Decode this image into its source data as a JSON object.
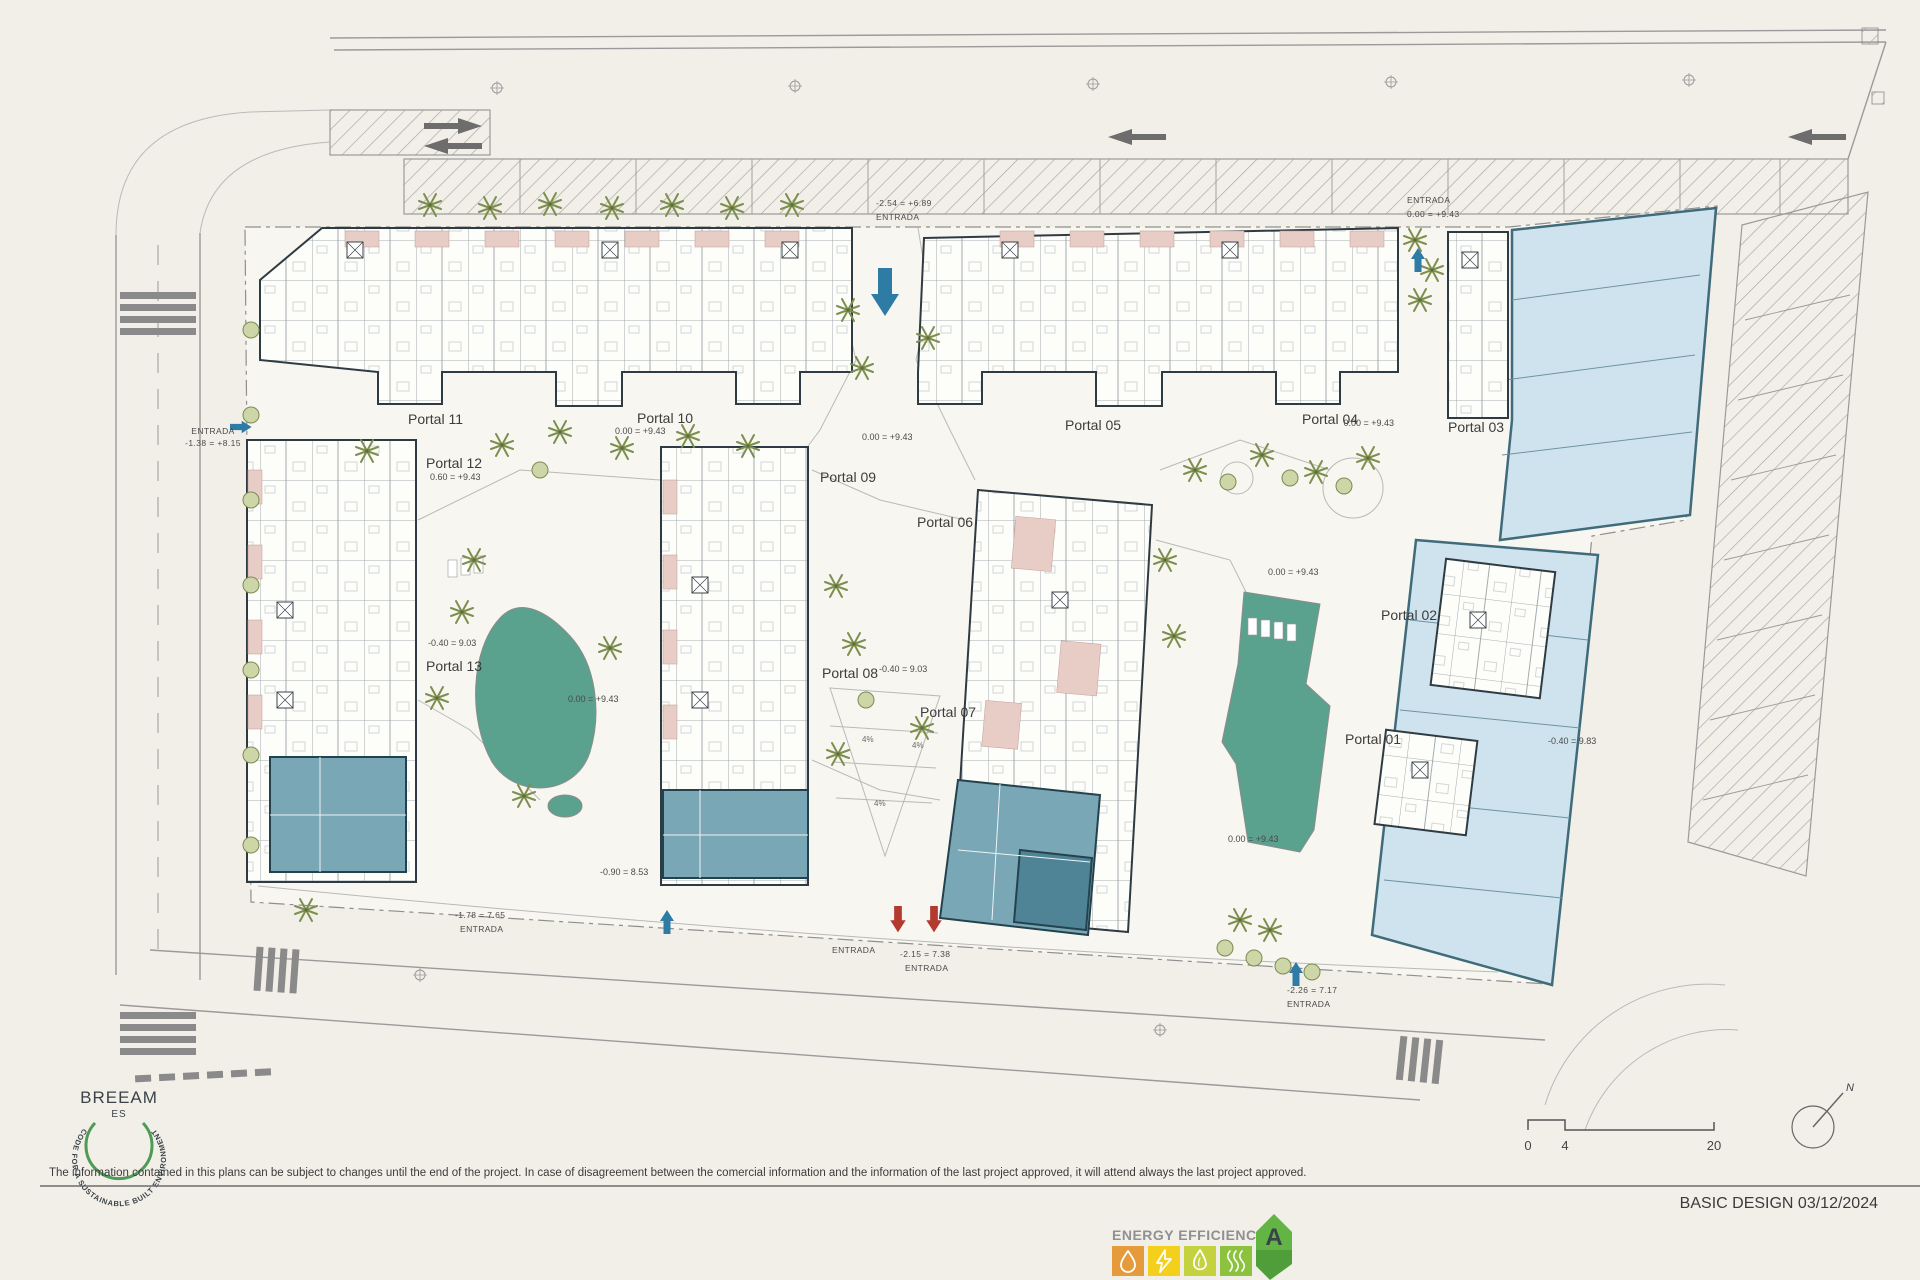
{
  "doc": {
    "disclaimer": "The information contained in this plans can be subject to changes until the end of the project. In case of disagreement between the comercial information and the information of the last project approved, it will attend always the last project approved.",
    "title_block": "BASIC DESIGN 03/12/2024"
  },
  "plan": {
    "portals": [
      {
        "label": "Portal 01"
      },
      {
        "label": "Portal 02"
      },
      {
        "label": "Portal 03"
      },
      {
        "label": "Portal 04"
      },
      {
        "label": "Portal 05"
      },
      {
        "label": "Portal 06"
      },
      {
        "label": "Portal 07"
      },
      {
        "label": "Portal 08"
      },
      {
        "label": "Portal 09"
      },
      {
        "label": "Portal 10"
      },
      {
        "label": "Portal 11"
      },
      {
        "label": "Portal 12"
      },
      {
        "label": "Portal 13"
      }
    ],
    "levels": [
      {
        "text": "0.00 = +9.43"
      },
      {
        "text": "0.00 = +9.43"
      },
      {
        "text": "0.60 = +9.43"
      },
      {
        "text": "0.00 = +9.43"
      },
      {
        "text": "0.00 = +9.43"
      },
      {
        "text": "-0.40 = 9.03"
      },
      {
        "text": "-0.40 = 9.03"
      },
      {
        "text": "0.00 = +9.43"
      },
      {
        "text": "0.00 = +9.43"
      },
      {
        "text": "-0.40 = 9.83"
      },
      {
        "text": "-0.90 = 8.53"
      }
    ],
    "entrances": [
      {
        "l1": "ENTRADA",
        "l2": "-1.38 = +8.15"
      },
      {
        "l1": "-2.54 = +6.89",
        "l2": "ENTRADA"
      },
      {
        "l1": "ENTRADA",
        "l2": "0.00 = +9.43"
      },
      {
        "l1": "-1.78 = 7.65",
        "l2": "ENTRADA"
      },
      {
        "l1": "ENTRADA",
        "l2": ""
      },
      {
        "l1": "-2.15 = 7.38",
        "l2": "ENTRADA"
      },
      {
        "l1": "-2.26 = 7.17",
        "l2": "ENTRADA"
      }
    ],
    "ramp_grade": "4%",
    "scale_bar": {
      "t0": "0",
      "t1": "4",
      "t2": "20"
    },
    "compass_n": "N"
  },
  "breeam": {
    "name": "BREEAM",
    "region": "ES",
    "ring_text": "CODE FOR A SUSTAINABLE BUILT ENVIRONMENT"
  },
  "energy": {
    "title": "ENERGY EFFICIENCY",
    "grade": "A"
  },
  "colors": {
    "pool": "#5aa18e",
    "commercial_fill": "#cfe3ee",
    "commercial_line": "#3f6b7a",
    "amenity": "#79a7b5",
    "amenity_dark": "#4f8496",
    "terrace": "#e7cdc6",
    "tree": "#7d8f4e",
    "bush_fill": "#cdd6a6",
    "arrow_blue": "#2e7ba6",
    "arrow_red": "#b23a2e",
    "energy_a_main": "#62b545",
    "energy_a_tail": "#4f9e3a",
    "energy_water": "#e59a3b",
    "energy_bolt": "#f4d01d",
    "energy_flame": "#c4d23f",
    "energy_waves": "#8cc23e",
    "breeam": "#4e9b57",
    "ink": "#3a4348"
  }
}
